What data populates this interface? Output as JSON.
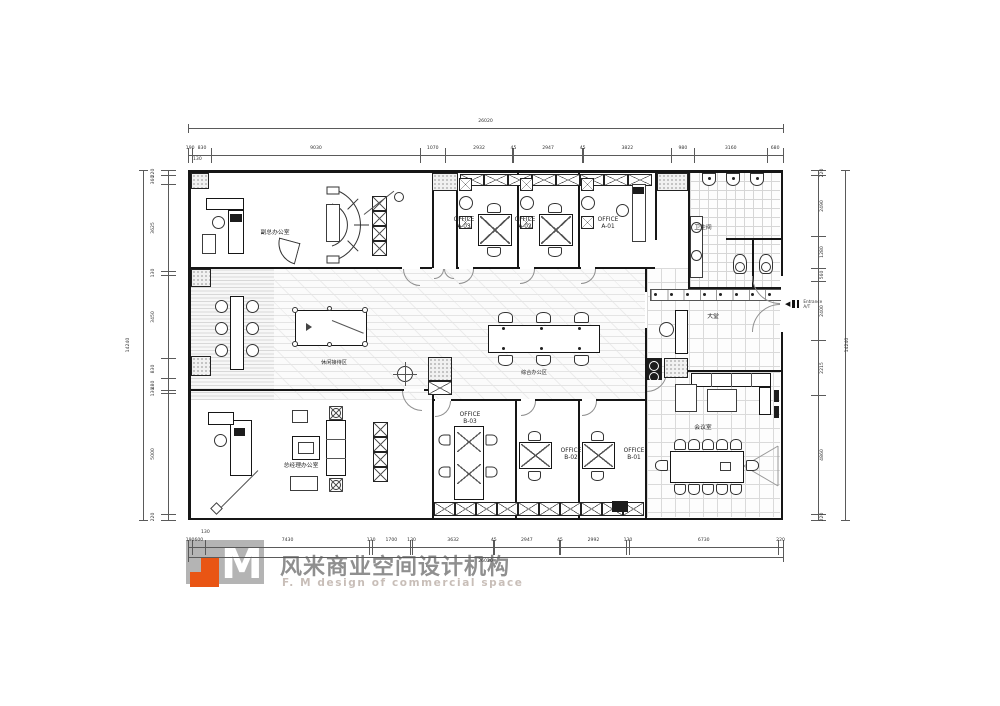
{
  "dims": {
    "top": {
      "segments": [
        190,
        830,
        9030,
        1070,
        2932,
        45,
        2947,
        45,
        3822,
        980,
        3160,
        680
      ],
      "total": "26020"
    },
    "bottom": {
      "segments": [
        190,
        600,
        7430,
        130,
        1700,
        130,
        3632,
        45,
        2947,
        45,
        2992,
        130,
        6730,
        220
      ],
      "total": "26020"
    },
    "left": {
      "segments": [
        220,
        360,
        3625,
        130,
        3450,
        830,
        480,
        130,
        5000,
        220
      ],
      "total": "14240"
    },
    "right": {
      "segments": [
        220,
        2490,
        1280,
        560,
        2400,
        2215,
        4860,
        220
      ],
      "total": "14240"
    },
    "extra": {
      "top_130": "130",
      "bottom_130": "130"
    }
  },
  "rooms": {
    "deputy_office": "副总办公室",
    "office_a03": "OFFICE\nA-03",
    "office_a02": "OFFICE\nA-02",
    "office_a01": "OFFICE\nA-01",
    "restroom": "卫生间",
    "leisure": "休闲接待区",
    "general_office": "综合办公区",
    "lobby": "大堂",
    "gm_office": "总经理办公室",
    "office_b03": "OFFICE\nB-03",
    "office_b02": "OFFICE\nB-02",
    "office_b01": "OFFICE\nB-01",
    "meeting": "会议室"
  },
  "entrance": {
    "line1": "Entrance",
    "line2": "A/T"
  },
  "logo": {
    "cn": "风米商业空间设计机构",
    "en": "F. M design of commercial space"
  },
  "colors": {
    "accent_orange": "#e95514",
    "logo_gray": "#b4b4b4",
    "wall": "#161616"
  }
}
